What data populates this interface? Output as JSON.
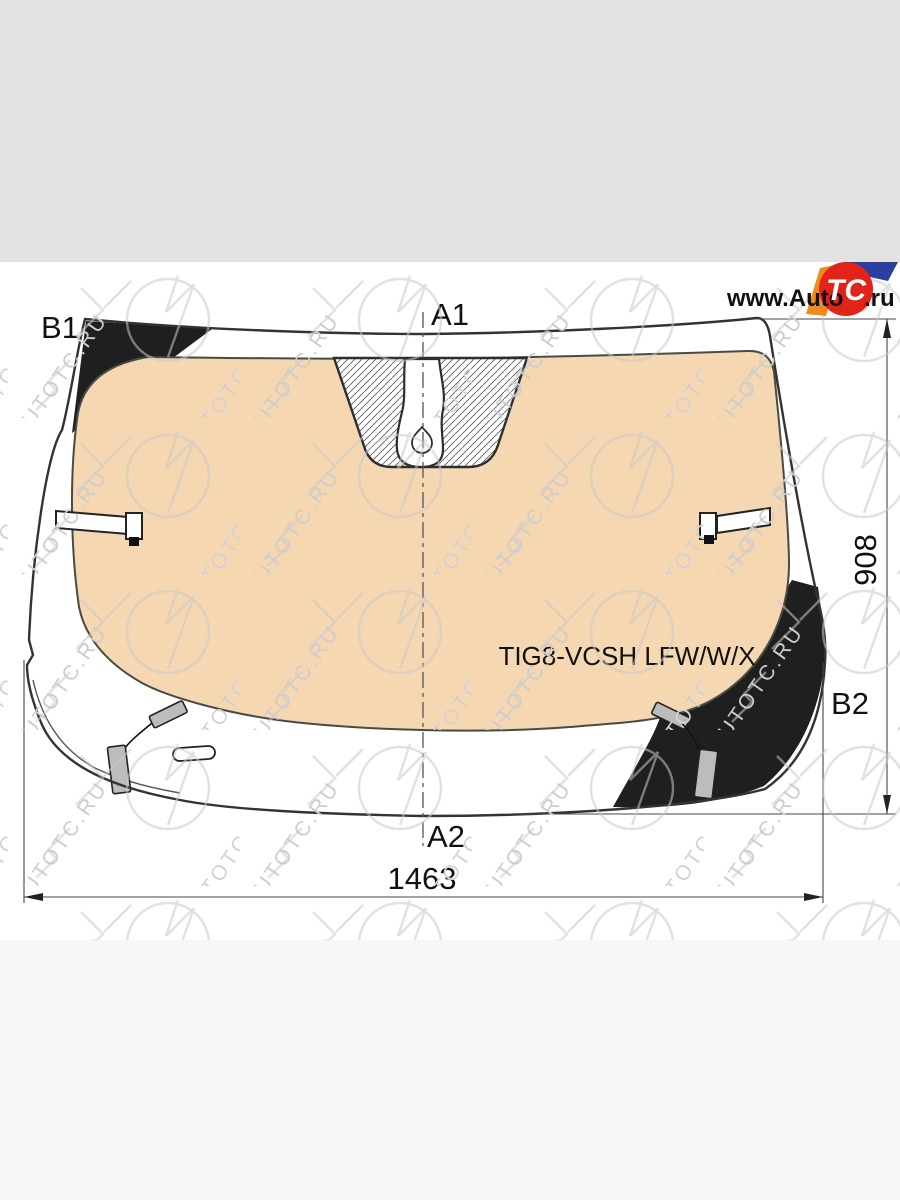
{
  "page": {
    "top_band_color": "#e3e3e3",
    "canvas_color": "#ffffff",
    "bottom_band_color": "#f7f7f7"
  },
  "logo": {
    "prefix": "www.Auto",
    "badge": "TC",
    "suffix": ".ru",
    "red": "#e2231a",
    "orange": "#ef8b1d",
    "blue": "#2b3f9e",
    "text_color": "#111111"
  },
  "watermark": {
    "text": "AUTOTC.RU"
  },
  "diagram": {
    "part_number": "TIG8-VCSH LFW/W/X",
    "labels": {
      "top_left": "B1",
      "top_center": "A1",
      "right": "B2",
      "bottom_center": "A2"
    },
    "dimensions": {
      "width": "1463",
      "height": "908"
    },
    "colors": {
      "sunshade": "#f5d7b2",
      "frit": "#1f1f1f",
      "clip_gray": "#bcbcbc",
      "line": "#333333",
      "dim_line": "#444444"
    }
  }
}
